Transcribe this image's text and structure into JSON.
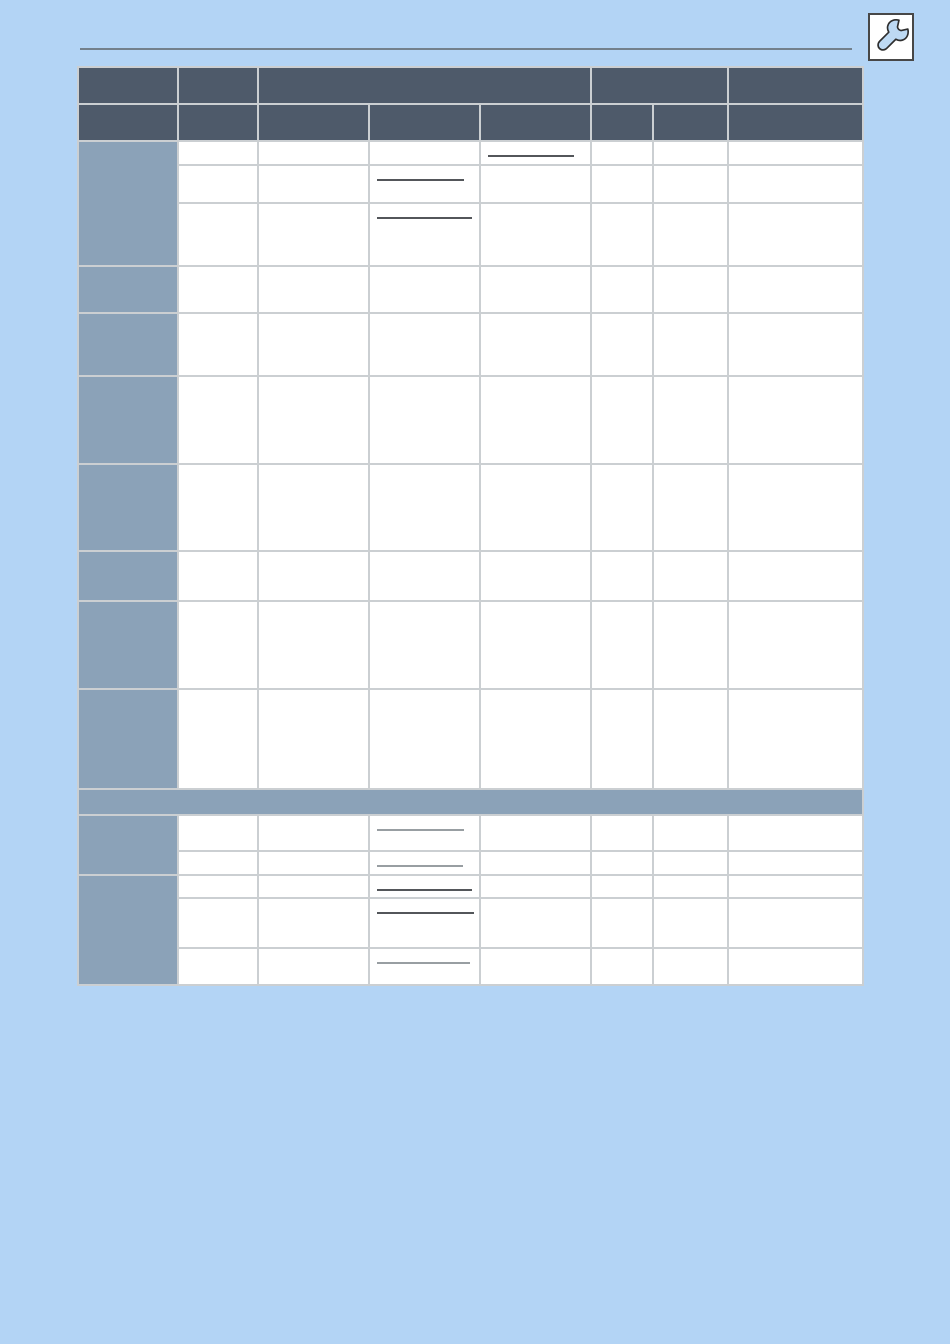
{
  "page": {
    "background_color": "#b3d4f5",
    "header_rule_color": "#73808c"
  },
  "toolbar": {
    "tool_button": {
      "icon": "wrench-icon",
      "background": "#ffffff",
      "border_color": "#474747",
      "wrench_fill": "#bdd9f3",
      "wrench_outline": "#2e2e2e"
    }
  },
  "table": {
    "colors": {
      "header_bg": "#4e5a6a",
      "row_header_bg": "#8ba2b8",
      "separator_bg": "#8ba2b8",
      "cell_bg": "#ffffff",
      "grid_line": "#cbcfd2",
      "outer_border": "#b7bbbe",
      "underline_dark": "#53565a",
      "underline_light": "#989ea2"
    },
    "column_widths_px": [
      100,
      80,
      111,
      111,
      111,
      62,
      75,
      135
    ],
    "header_rows": [
      {
        "height_px": 37,
        "cells": [
          {
            "colspan": 1,
            "label": ""
          },
          {
            "colspan": 1,
            "label": ""
          },
          {
            "colspan": 3,
            "label": ""
          },
          {
            "colspan": 2,
            "label": ""
          },
          {
            "colspan": 1,
            "label": ""
          }
        ]
      },
      {
        "height_px": 37,
        "cells": [
          {
            "colspan": 1,
            "label": ""
          },
          {
            "colspan": 1,
            "label": ""
          },
          {
            "colspan": 1,
            "label": ""
          },
          {
            "colspan": 1,
            "label": ""
          },
          {
            "colspan": 1,
            "label": ""
          },
          {
            "colspan": 1,
            "label": ""
          },
          {
            "colspan": 1,
            "label": ""
          },
          {
            "colspan": 1,
            "label": ""
          }
        ]
      }
    ],
    "body_sections": [
      {
        "type": "group",
        "header_label": "",
        "rows": [
          {
            "height_px": 24,
            "cells": [
              "",
              "",
              "",
              "",
              "",
              "",
              ""
            ],
            "blank_line": {
              "col": 5,
              "width_px": 86,
              "tone": "dark"
            }
          },
          {
            "height_px": 38,
            "cells": [
              "",
              "",
              "",
              "",
              "",
              "",
              ""
            ],
            "blank_line": {
              "col": 4,
              "width_px": 87,
              "tone": "dark"
            }
          },
          {
            "height_px": 63,
            "cells": [
              "",
              "",
              "",
              "",
              "",
              "",
              ""
            ],
            "blank_line": {
              "col": 4,
              "width_px": 95,
              "tone": "dark"
            }
          }
        ]
      },
      {
        "type": "group",
        "header_label": "",
        "rows": [
          {
            "height_px": 47,
            "cells": [
              "",
              "",
              "",
              "",
              "",
              "",
              ""
            ]
          }
        ]
      },
      {
        "type": "group",
        "header_label": "",
        "rows": [
          {
            "height_px": 63,
            "cells": [
              "",
              "",
              "",
              "",
              "",
              "",
              ""
            ]
          }
        ]
      },
      {
        "type": "group",
        "header_label": "",
        "rows": [
          {
            "height_px": 88,
            "cells": [
              "",
              "",
              "",
              "",
              "",
              "",
              ""
            ]
          }
        ]
      },
      {
        "type": "group",
        "header_label": "",
        "rows": [
          {
            "height_px": 87,
            "cells": [
              "",
              "",
              "",
              "",
              "",
              "",
              ""
            ]
          }
        ]
      },
      {
        "type": "group",
        "header_label": "",
        "rows": [
          {
            "height_px": 50,
            "cells": [
              "",
              "",
              "",
              "",
              "",
              "",
              ""
            ]
          }
        ]
      },
      {
        "type": "group",
        "header_label": "",
        "rows": [
          {
            "height_px": 88,
            "cells": [
              "",
              "",
              "",
              "",
              "",
              "",
              ""
            ]
          }
        ]
      },
      {
        "type": "group",
        "header_label": "",
        "rows": [
          {
            "height_px": 100,
            "cells": [
              "",
              "",
              "",
              "",
              "",
              "",
              ""
            ]
          }
        ]
      },
      {
        "type": "separator",
        "height_px": 26,
        "label": ""
      },
      {
        "type": "group",
        "header_label": "",
        "rows": [
          {
            "height_px": 36,
            "cells": [
              "",
              "",
              "",
              "",
              "",
              "",
              ""
            ],
            "blank_line": {
              "col": 4,
              "width_px": 87,
              "tone": "light"
            }
          },
          {
            "height_px": 24,
            "cells": [
              "",
              "",
              "",
              "",
              "",
              "",
              ""
            ],
            "blank_line": {
              "col": 4,
              "width_px": 86,
              "tone": "light"
            }
          }
        ]
      },
      {
        "type": "group",
        "header_label": "",
        "rows": [
          {
            "height_px": 23,
            "cells": [
              "",
              "",
              "",
              "",
              "",
              "",
              ""
            ],
            "blank_line": {
              "col": 4,
              "width_px": 95,
              "tone": "dark"
            }
          },
          {
            "height_px": 50,
            "cells": [
              "",
              "",
              "",
              "",
              "",
              "",
              ""
            ],
            "blank_line": {
              "col": 4,
              "width_px": 97,
              "tone": "dark"
            }
          },
          {
            "height_px": 37,
            "cells": [
              "",
              "",
              "",
              "",
              "",
              "",
              ""
            ],
            "blank_line": {
              "col": 4,
              "width_px": 93,
              "tone": "light"
            }
          }
        ]
      }
    ]
  }
}
